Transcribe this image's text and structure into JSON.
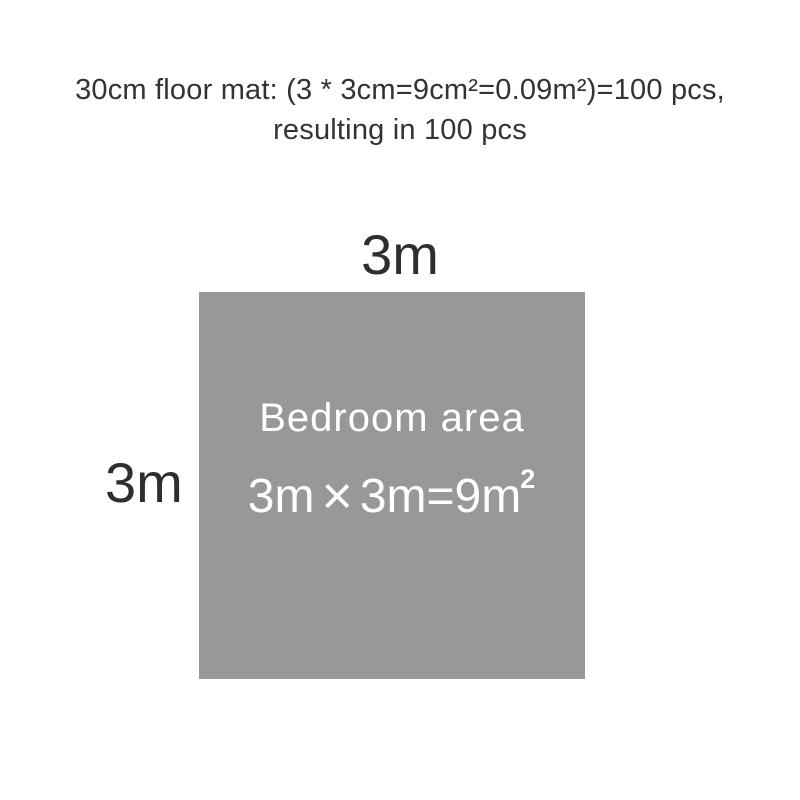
{
  "caption": {
    "line1": "30cm floor mat: (3 * 3cm=9cm²=0.09m²)=100 pcs,",
    "line2": "resulting in 100 pcs"
  },
  "diagram": {
    "top_label": "3m",
    "left_label": "3m",
    "area_label": "Bedroom area",
    "formula": {
      "left_operand": "3m",
      "times_sign": "×",
      "right_part": "3m=9m",
      "exponent": "2"
    },
    "colors": {
      "square_fill": "#989898",
      "area_text": "#ffffff",
      "caption_text": "#333333",
      "label_text": "#2e2e2e"
    }
  }
}
